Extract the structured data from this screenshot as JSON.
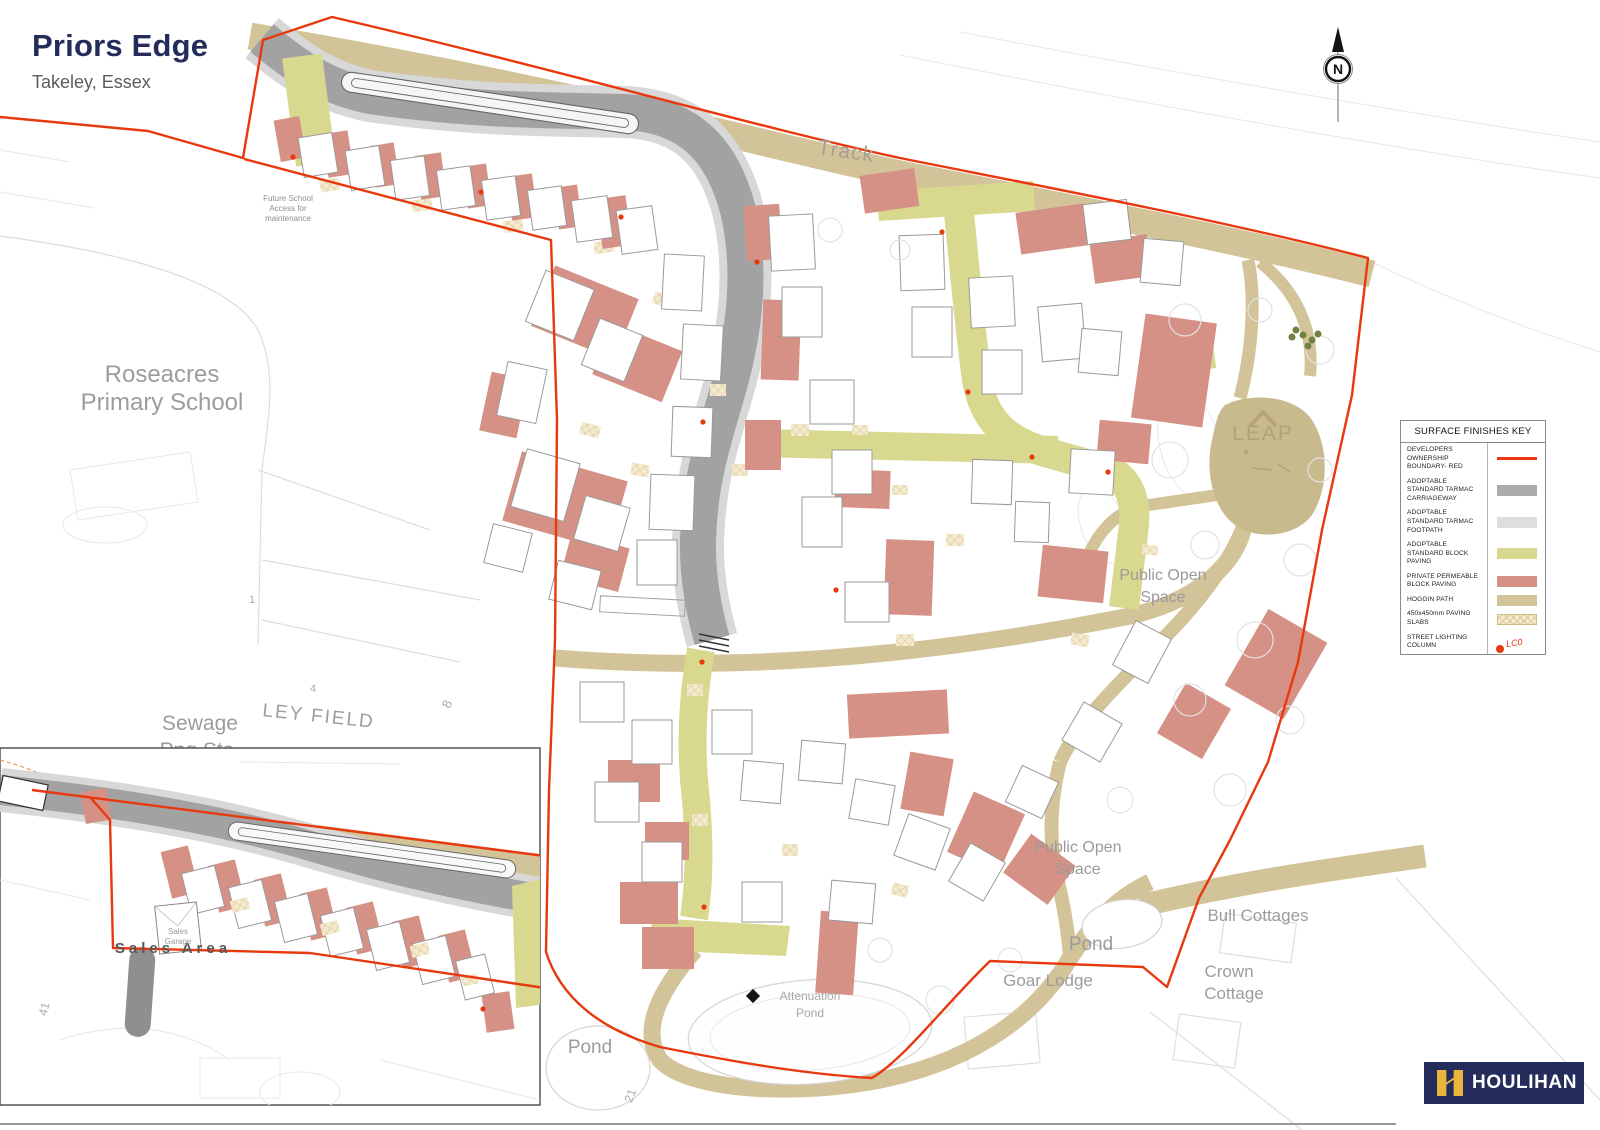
{
  "title": {
    "name": "Priors Edge",
    "location": "Takeley, Essex"
  },
  "north": {
    "label": "N"
  },
  "legend": {
    "title": "SURFACE FINISHES KEY",
    "items": [
      {
        "label": "DEVELOPERS OWNERSHIP BOUNDARY- RED",
        "swatch": "red-line"
      },
      {
        "label": "ADOPTABLE STANDARD TARMAC CARRIAGEWAY",
        "swatch": "gray"
      },
      {
        "label": "ADOPTABLE STANDARD TARMAC FOOTPATH",
        "swatch": "lightgray"
      },
      {
        "label": "ADOPTABLE STANDARD BLOCK  PAVING",
        "swatch": "olive"
      },
      {
        "label": "PRIVATE PERMEABLE BLOCK PAVING",
        "swatch": "salmon"
      },
      {
        "label": "HOGGIN PATH",
        "swatch": "tan"
      },
      {
        "label": "450x450mm PAVING SLABS",
        "swatch": "slabs"
      },
      {
        "label": "STREET LIGHTING COLUMN",
        "swatch": "light-column",
        "note": "LC0"
      }
    ]
  },
  "logo": {
    "text": "HOULIHAN"
  },
  "colors": {
    "boundary": "#e8380d",
    "carriageway": "#a2a2a2",
    "footpath": "#d8d8d8",
    "olive": "#d8d98e",
    "salmon": "#d69186",
    "hoggin": "#d2c398",
    "tan_dark": "#c9ba8e",
    "navy": "#232c5a",
    "gold": "#eab53d"
  },
  "map": {
    "labels": [
      {
        "text": "Sewage",
        "x": 200,
        "y": 730,
        "size": 21,
        "color": "#9c9c9c",
        "layer": "base"
      },
      {
        "text": "Png Sta",
        "x": 197,
        "y": 757,
        "size": 21,
        "color": "#9c9c9c",
        "layer": "base"
      },
      {
        "text": "Track",
        "x": 845,
        "y": 158,
        "size": 21,
        "rot": 8,
        "color": "#a7a195",
        "spacing": 1
      },
      {
        "text": "Roseacres",
        "x": 162,
        "y": 382,
        "size": 24,
        "color": "#9c9c9c"
      },
      {
        "text": "Primary School",
        "x": 162,
        "y": 410,
        "size": 24,
        "color": "#9c9c9c"
      },
      {
        "text": "LEY FIELD",
        "x": 318,
        "y": 722,
        "size": 19,
        "rot": 6,
        "color": "#9c9c9c",
        "spacing": 2
      },
      {
        "text": "4",
        "x": 313,
        "y": 692,
        "size": 11,
        "color": "#ababab"
      },
      {
        "text": "1",
        "x": 252,
        "y": 603,
        "size": 11,
        "color": "#ababab"
      },
      {
        "text": "8",
        "x": 451,
        "y": 706,
        "size": 13,
        "rot": -65,
        "color": "#ababab"
      },
      {
        "text": "Public Open",
        "x": 1163,
        "y": 580,
        "size": 16,
        "color": "#9a9a9a"
      },
      {
        "text": "Space",
        "x": 1163,
        "y": 602,
        "size": 16,
        "color": "#9a9a9a"
      },
      {
        "text": "LEAP",
        "x": 1263,
        "y": 440,
        "size": 21,
        "color": "#b2a277",
        "spacing": 2
      },
      {
        "text": "Public Open",
        "x": 1078,
        "y": 852,
        "size": 16,
        "color": "#9a9a9a"
      },
      {
        "text": "Space",
        "x": 1078,
        "y": 874,
        "size": 16,
        "color": "#9a9a9a"
      },
      {
        "text": "Pond",
        "x": 1091,
        "y": 950,
        "size": 19,
        "color": "#9c9c9c"
      },
      {
        "text": "Bull Cottages",
        "x": 1258,
        "y": 921,
        "size": 17,
        "color": "#9c9c9c"
      },
      {
        "text": "Crown",
        "x": 1229,
        "y": 977,
        "size": 17,
        "color": "#9c9c9c"
      },
      {
        "text": "Cottage",
        "x": 1234,
        "y": 999,
        "size": 17,
        "color": "#9c9c9c"
      },
      {
        "text": "Goar Lodge",
        "x": 1048,
        "y": 986,
        "size": 17,
        "color": "#9c9c9c"
      },
      {
        "text": "Attenuation",
        "x": 810,
        "y": 1000,
        "size": 12,
        "color": "#a8a8a8"
      },
      {
        "text": "Pond",
        "x": 810,
        "y": 1017,
        "size": 12,
        "color": "#a8a8a8"
      },
      {
        "text": "Pond",
        "x": 590,
        "y": 1053,
        "size": 19,
        "color": "#9c9c9c"
      },
      {
        "text": "Future School",
        "x": 288,
        "y": 201,
        "size": 8,
        "color": "#8f8f8f"
      },
      {
        "text": "Access for",
        "x": 288,
        "y": 211,
        "size": 8,
        "color": "#8f8f8f"
      },
      {
        "text": "maintenance",
        "x": 288,
        "y": 221,
        "size": 8,
        "color": "#8f8f8f"
      },
      {
        "text": "21",
        "x": 634,
        "y": 1097,
        "size": 12,
        "rot": -70,
        "color": "#ababab"
      },
      {
        "text": "Sales Area",
        "x": 173,
        "y": 953,
        "size": 15,
        "weight": 700,
        "color": "#585858",
        "spacing": 4
      },
      {
        "text": "Sales",
        "x": 178,
        "y": 934,
        "size": 8,
        "color": "#999999"
      },
      {
        "text": "Garage",
        "x": 178,
        "y": 944,
        "size": 8,
        "color": "#999999"
      },
      {
        "text": "41",
        "x": 48,
        "y": 1010,
        "size": 12,
        "rot": -75,
        "color": "#ababab"
      }
    ]
  }
}
